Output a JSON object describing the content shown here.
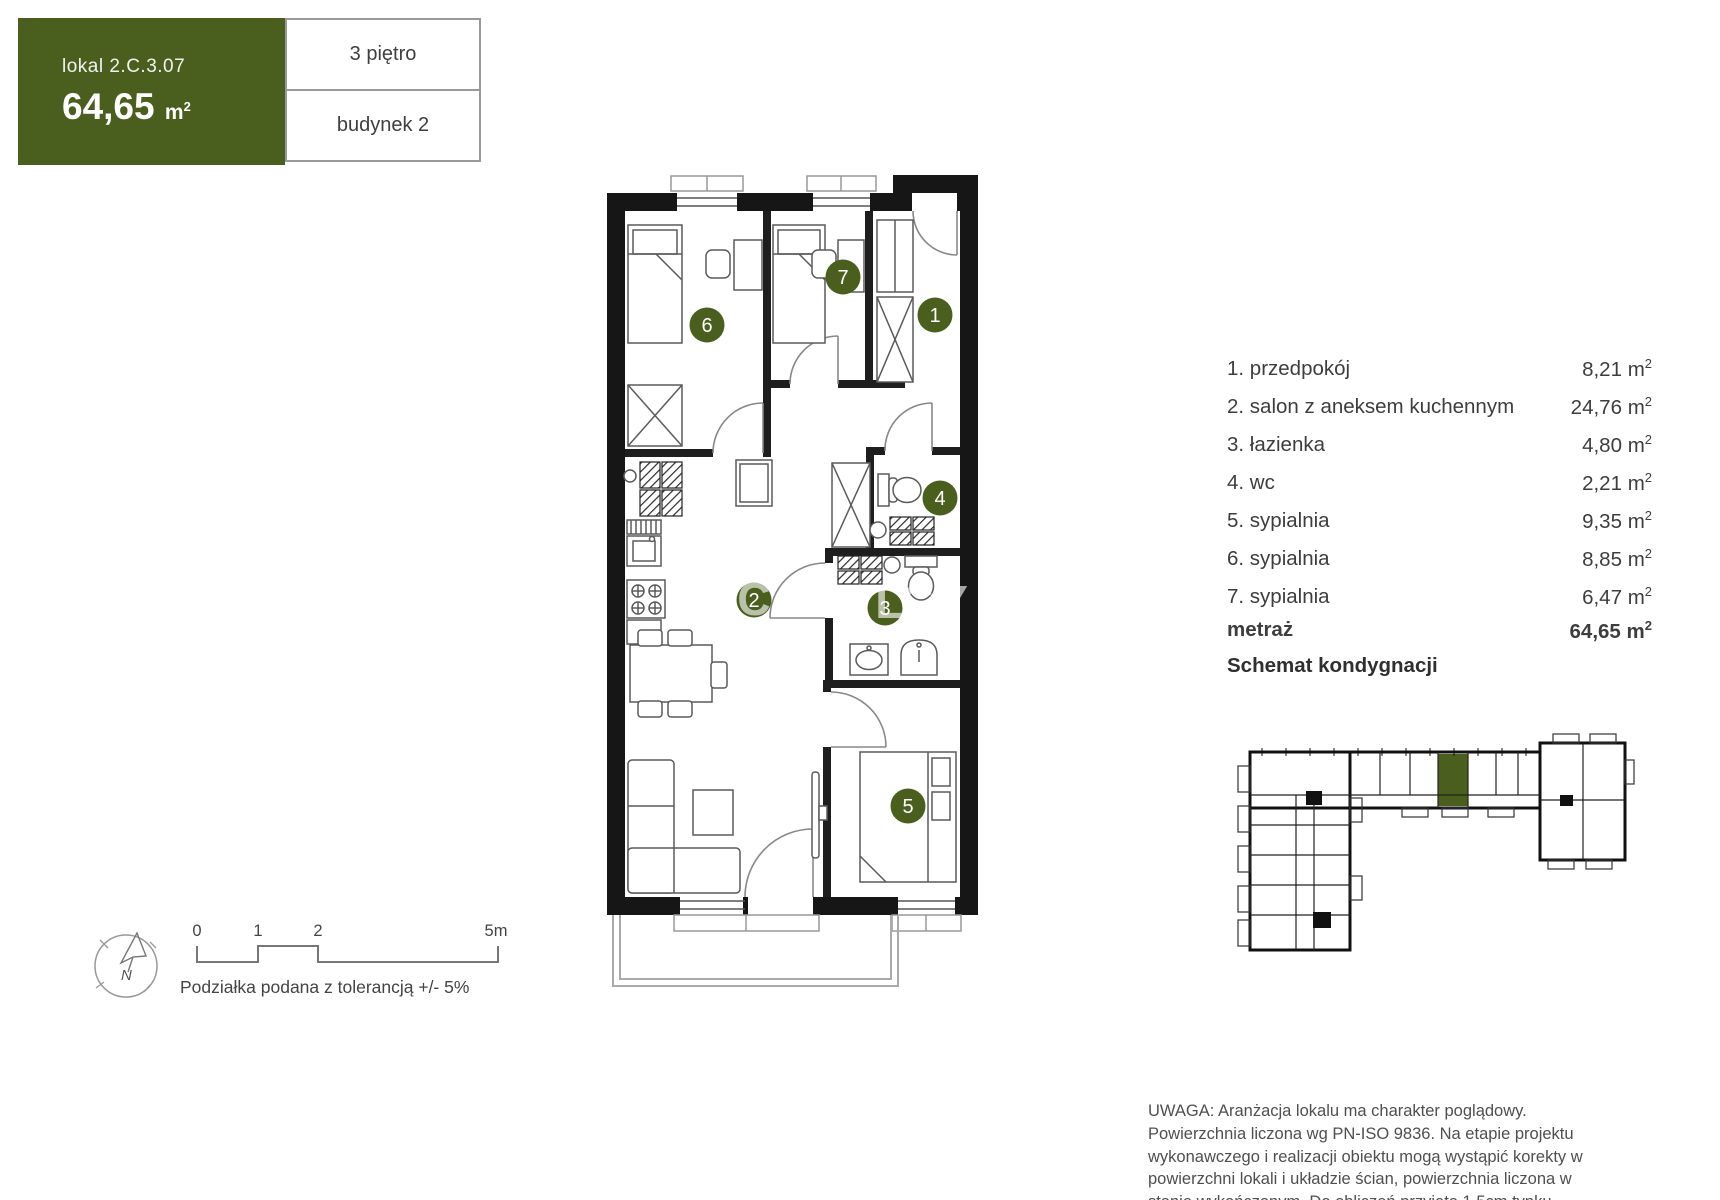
{
  "header": {
    "unit": "lokal 2.C.3.07",
    "area": "64,65",
    "floor": "3 piętro",
    "building": "budynek 2"
  },
  "unit_suffix": {
    "base": "m",
    "sup": "2"
  },
  "room_list": {
    "rooms": [
      {
        "num": "1",
        "label": "1. przedpokój",
        "area": "8,21"
      },
      {
        "num": "2",
        "label": "2. salon z aneksem kuchennym",
        "area": "24,76"
      },
      {
        "num": "3",
        "label": "3. łazienka",
        "area": "4,80"
      },
      {
        "num": "4",
        "label": "4. wc",
        "area": "2,21"
      },
      {
        "num": "5",
        "label": "5. sypialnia",
        "area": "9,35"
      },
      {
        "num": "6",
        "label": "6. sypialnia",
        "area": "8,85"
      },
      {
        "num": "7",
        "label": "7. sypialnia",
        "area": "6,47"
      }
    ],
    "total_label": "metraż",
    "total_area": "64,65"
  },
  "section_title": "Schemat kondygnacji",
  "scale_bar": {
    "labels": [
      "0",
      "1",
      "2",
      "5m"
    ],
    "note": "Podziałka podana z tolerancją +/- 5%"
  },
  "compass": {
    "north": "N"
  },
  "watermark": [
    "AC",
    "AL",
    "CY"
  ],
  "disclaimer": "UWAGA: Aranżacja lokalu ma charakter poglądowy. Powierzchnia liczona wg PN-ISO 9836. Na etapie projektu wykonawczego i realizacji obiektu mogą wystąpić korekty w powierzchni lokali i układzie ścian, powierzchnia liczona w stanie wykończonym. Do obliczeń przyjęto 1,5cm tynku.",
  "colors": {
    "accent": "#4a5e1d",
    "wall": "#161616"
  }
}
